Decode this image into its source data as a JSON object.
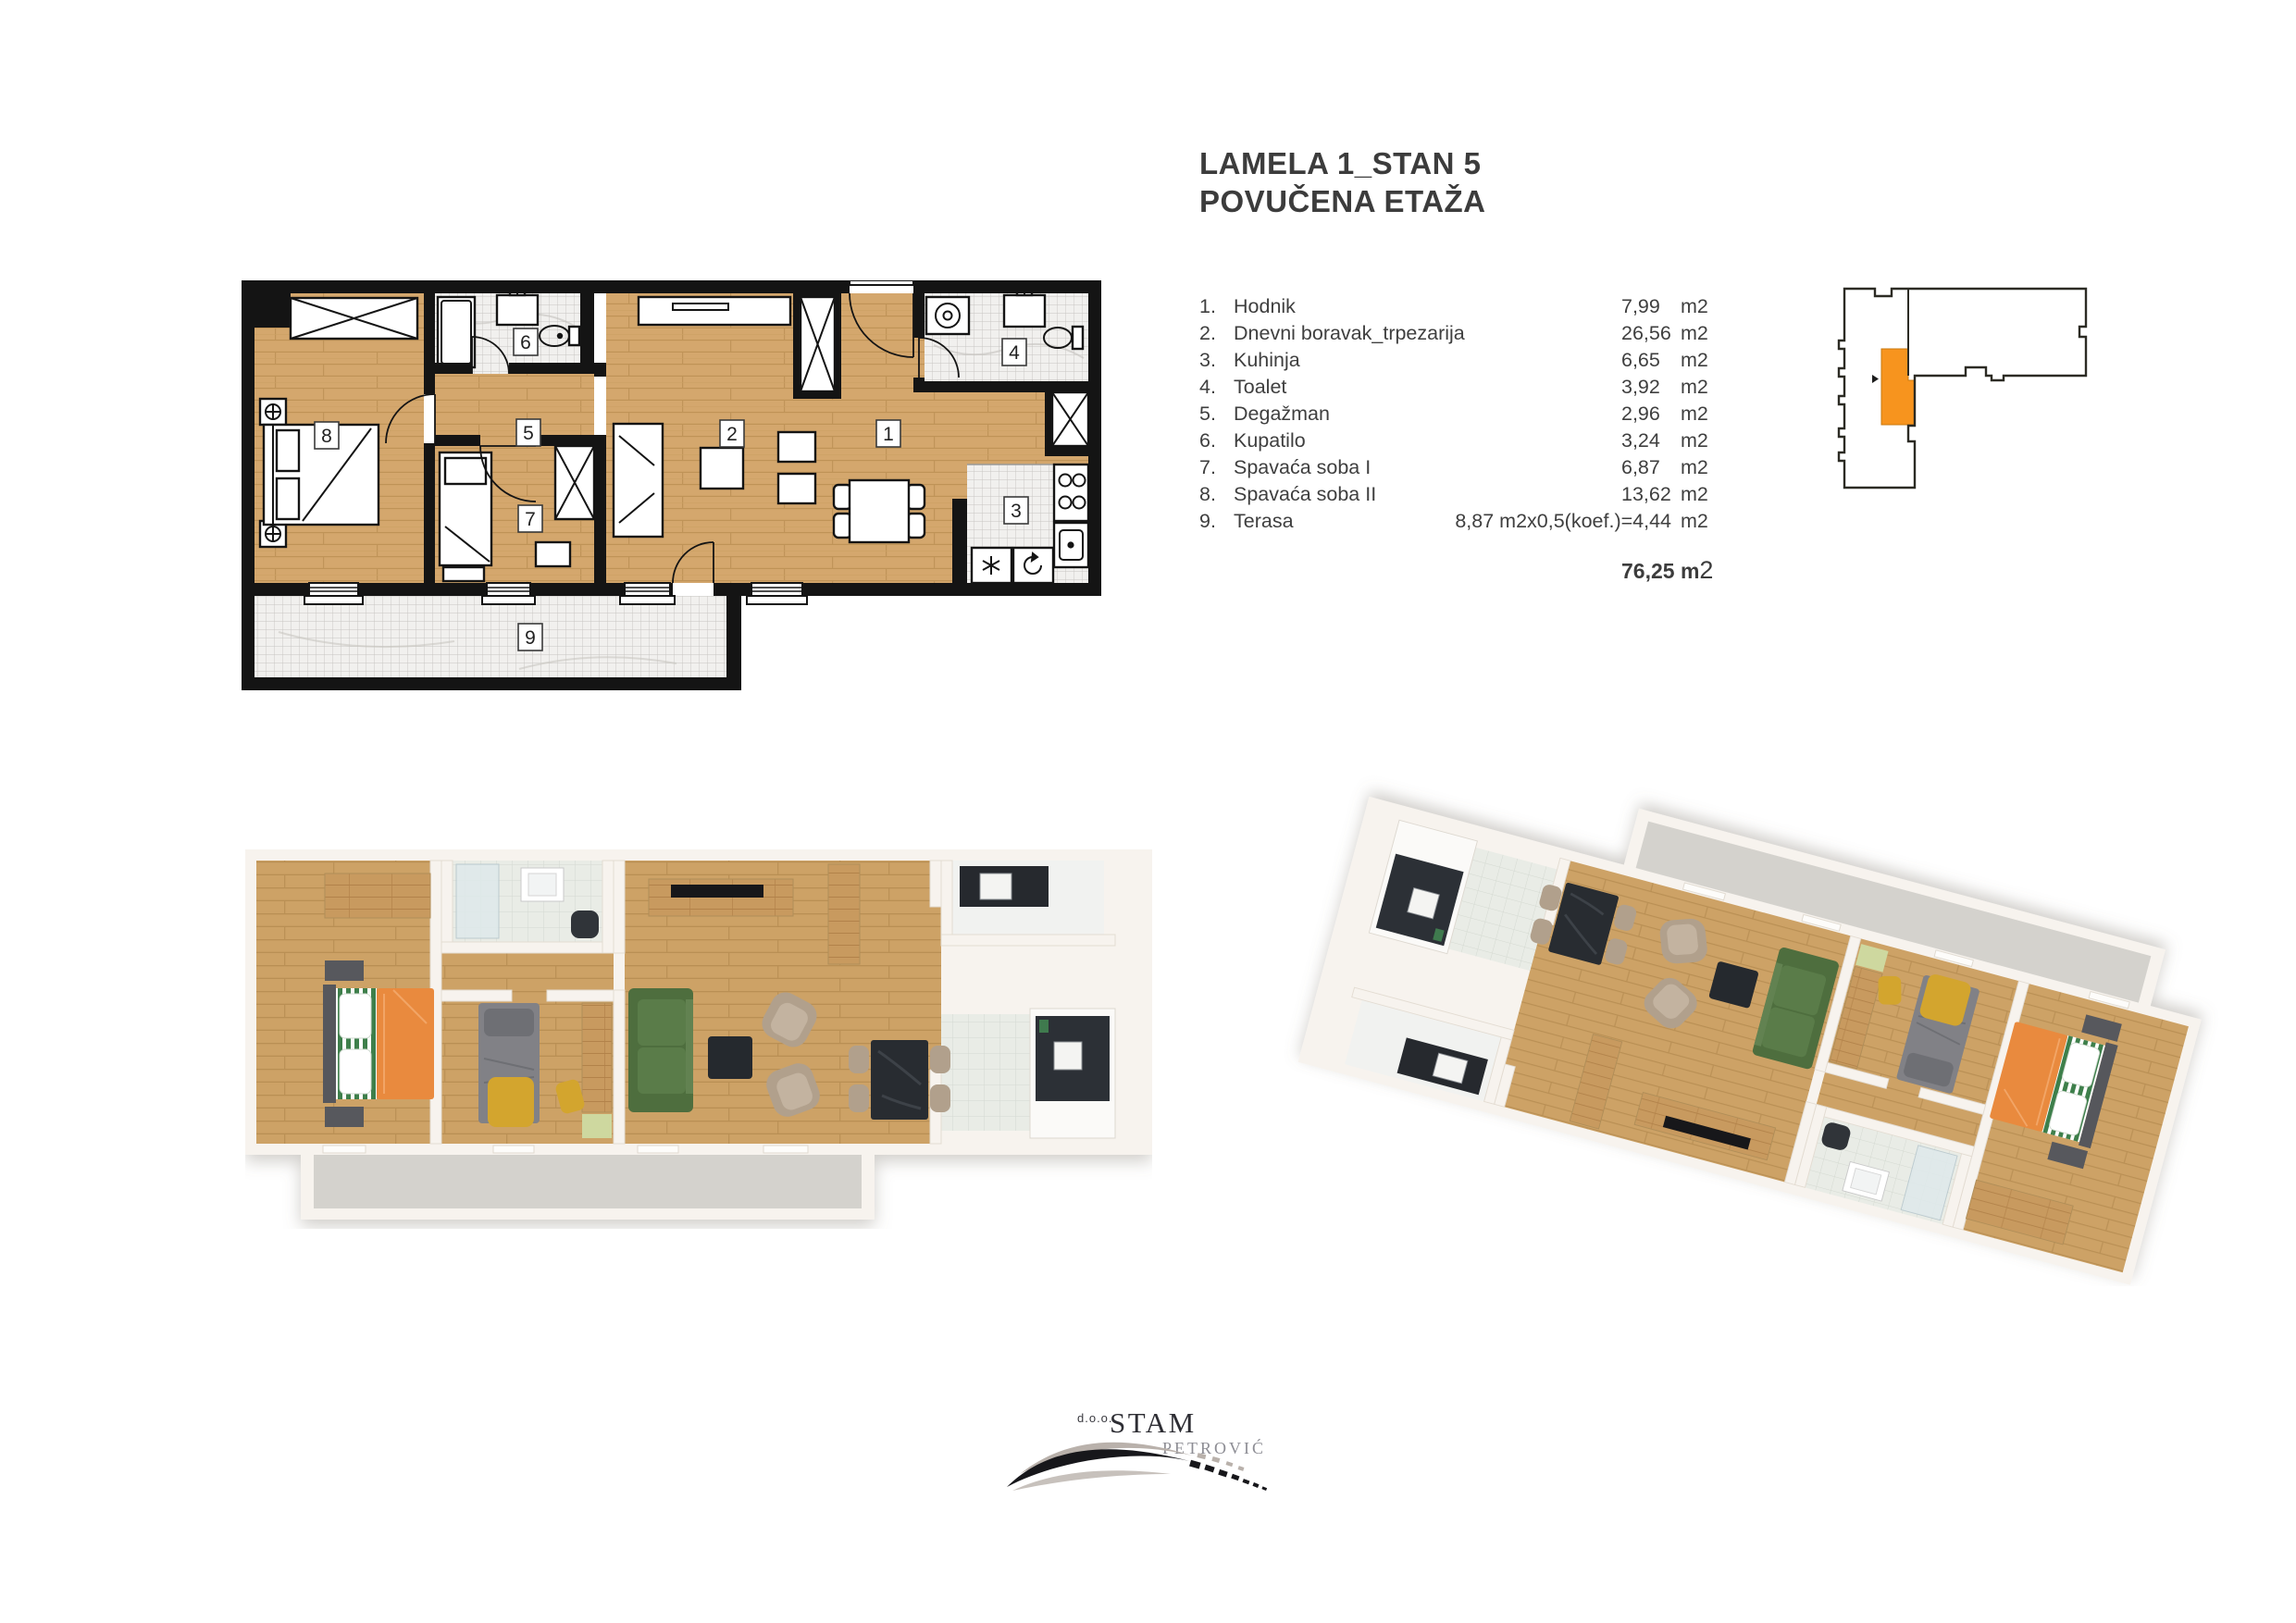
{
  "title": {
    "line1": "LAMELA 1_STAN 5",
    "line2": "POVUČENA ETAŽA"
  },
  "room_list": {
    "items": [
      {
        "num": "1.",
        "name": "Hodnik",
        "value": "7,99",
        "unit": "m2"
      },
      {
        "num": "2.",
        "name": "Dnevni boravak_trpezarija",
        "value": "26,56",
        "unit": "m2"
      },
      {
        "num": "3.",
        "name": "Kuhinja",
        "value": "6,65",
        "unit": "m2"
      },
      {
        "num": "4.",
        "name": "Toalet",
        "value": "3,92",
        "unit": "m2"
      },
      {
        "num": "5.",
        "name": "Degažman",
        "value": "2,96",
        "unit": "m2"
      },
      {
        "num": "6.",
        "name": "Kupatilo",
        "value": "3,24",
        "unit": "m2"
      },
      {
        "num": "7.",
        "name": "Spavaća soba I",
        "value": "6,87",
        "unit": "m2"
      },
      {
        "num": "8.",
        "name": "Spavaća soba II",
        "value": "13,62",
        "unit": "m2"
      },
      {
        "num": "9.",
        "name": "Terasa",
        "formula": "8,87 m2x0,5(koef.)=4,44",
        "unit": "m2"
      }
    ],
    "total_value": "76,25 m",
    "total_sup": "2"
  },
  "plan2d": {
    "room_numbers": [
      "1",
      "2",
      "3",
      "4",
      "5",
      "6",
      "7",
      "8",
      "9"
    ]
  },
  "logo": {
    "prefix": "d.o.o.",
    "name": "STAM",
    "subtitle": "PETROVIĆ"
  },
  "colors": {
    "highlight_orange": "#f7941e",
    "wall_black": "#141414",
    "wood": "#d4a76d",
    "tile": "#f1f0ee"
  }
}
